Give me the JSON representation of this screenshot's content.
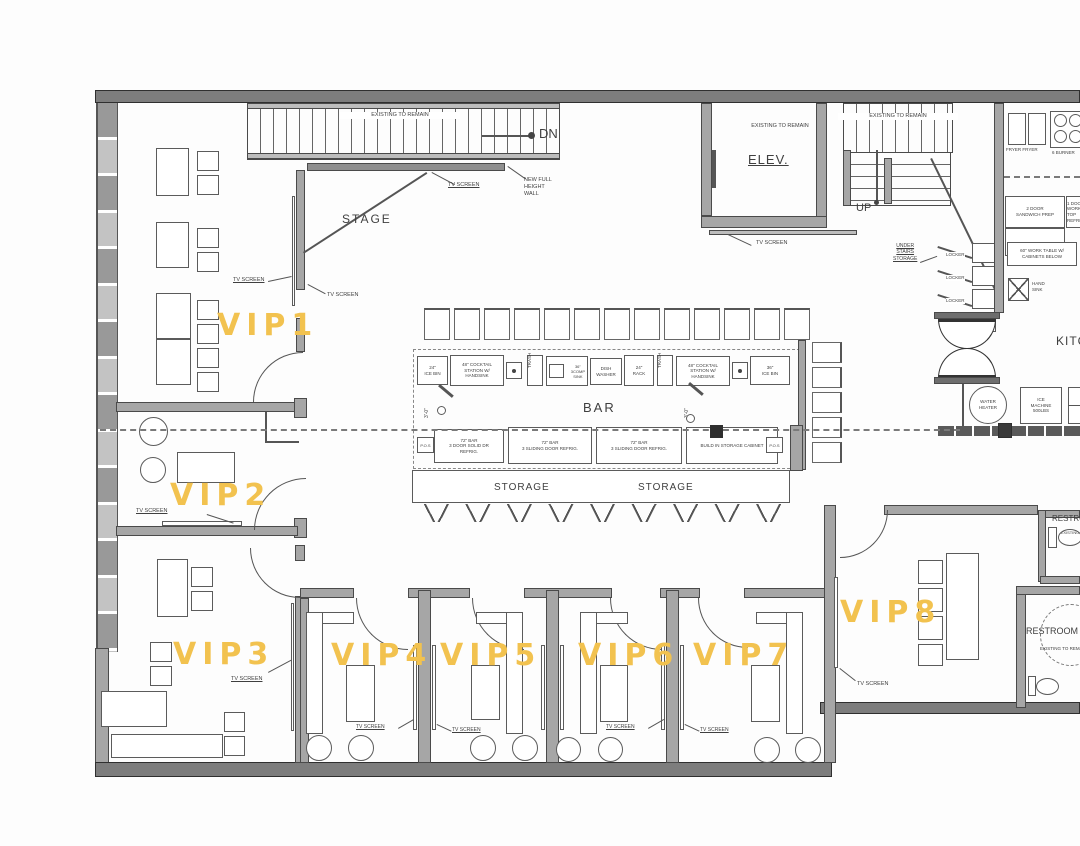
{
  "colors": {
    "vip_label": "#F2C24F",
    "line": "#555555",
    "wall": "#A6A6A6",
    "wall_dark": "#7D7D7D"
  },
  "labels": {
    "existing_to_remain": "EXISTING TO REMAIN",
    "tv_screen": "TV SCREEN",
    "new_wall": "NEW FULL\nHEIGHT\nWALL",
    "dn": "DN",
    "up": "UP",
    "stage": "STAGE",
    "elev": "ELEV.",
    "bar": "BAR",
    "storage": "STORAGE",
    "kitchen": "KITCHEN",
    "under_stairs": "UNDER\nSTAIRS\nSTORAGE",
    "locker": "LOCKER",
    "restroom": "RESTROOM",
    "toilet_existing": "EXISTING",
    "dim_3_0": "3'-0\""
  },
  "vip": [
    "VIP1",
    "VIP2",
    "VIP3",
    "VIP4",
    "VIP5",
    "VIP6",
    "VIP7",
    "VIP8"
  ],
  "bar_equipment": {
    "ice_bin_24": "24\"\nICE BIN",
    "cocktail_48": "48\" COCKTAIL\nSTATION W/\nHANDSINK",
    "trash": "TRASH",
    "sink_36": "36\"\n3COMP\nSINK",
    "dishwasher": "DISH\nWASHER",
    "rack_24": "24\"\nRACK",
    "ice_bin_36": "36\"\nICE BIN",
    "pos": "P.O.S",
    "bar72_solid": "72\" BAR\n3 DOOR SOLID DR\nREFRIG.",
    "bar72_sliding": "72\" BAR\n3 SLIDING DOOR REFRIG.",
    "build_in": "BUILD IN STORAGE CABINET"
  },
  "kitchen": {
    "fryer": "FRYER  FRYER",
    "burner": "6 BURNER",
    "sandwich": "2 DOOR\nSANDWICH PREP",
    "work_ref": "1 DOOR\nWORK TOP\nREFRIG.",
    "work_table": "60\" WORK TABLE W/\nCABINETS BELOW",
    "hand_sink": "HAND\nSINK",
    "water_heater": "WATER\nHEATER",
    "ice_machine": "ICE\nMACHINE\n500LBS"
  }
}
